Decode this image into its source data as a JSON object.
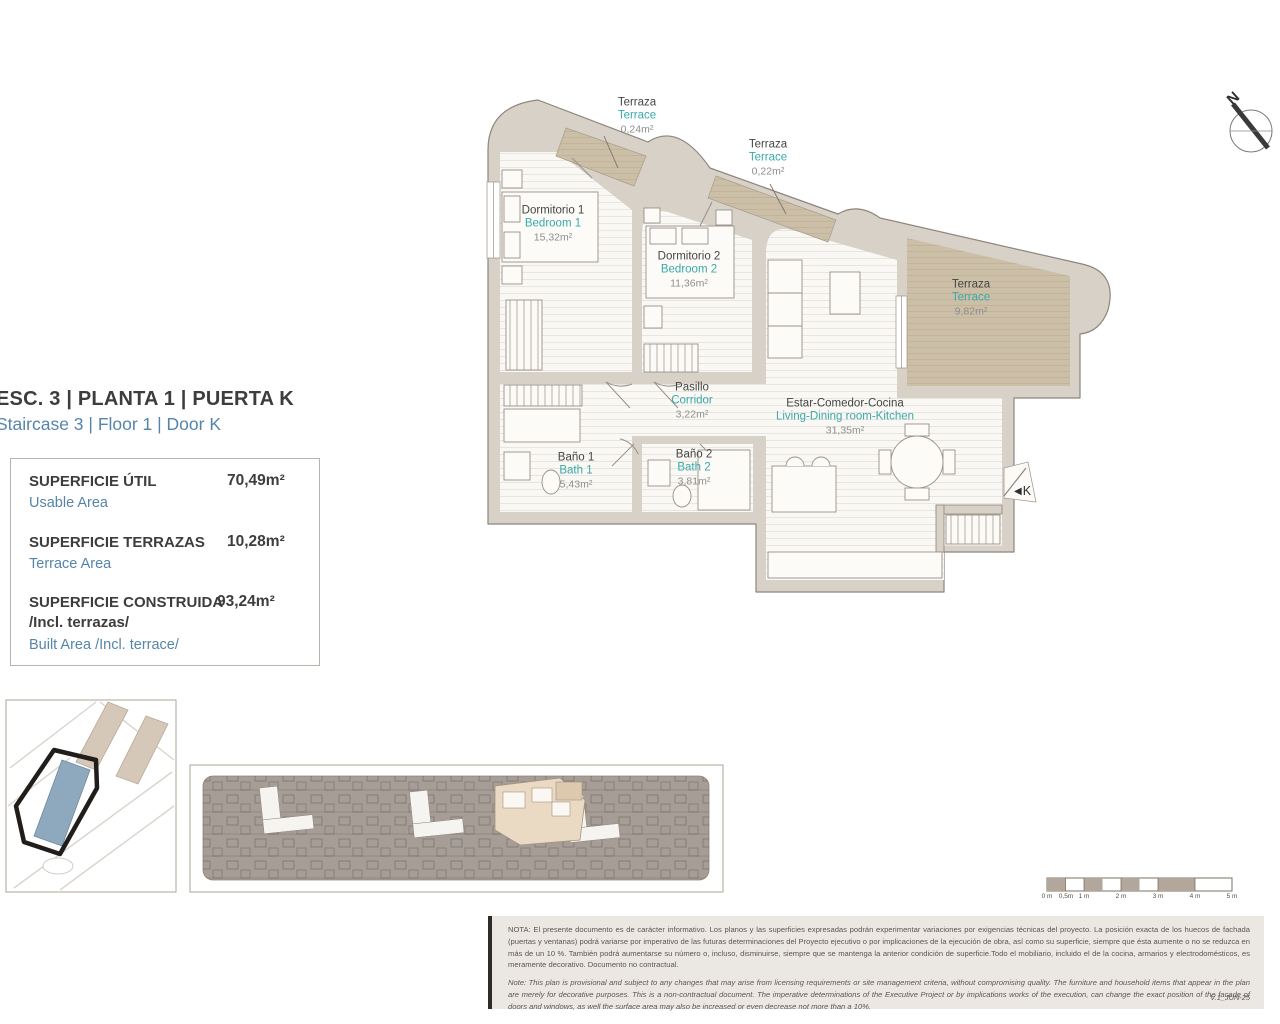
{
  "header": {
    "title_es": "ESC. 3 | PLANTA 1 | PUERTA K",
    "title_en": "Staircase 3 | Floor 1 | Door K"
  },
  "area_table": {
    "rows": [
      {
        "es": "SUPERFICIE ÚTIL",
        "en": "Usable Area",
        "value": "70,49m²"
      },
      {
        "es": "SUPERFICIE TERRAZAS",
        "en": "Terrace Area",
        "value": "10,28m²"
      },
      {
        "es": "SUPERFICIE CONSTRUIDA",
        "es_sub": "/Incl. terrazas/",
        "en": "Built Area /Incl. terrace/",
        "value": "93,24m²"
      }
    ]
  },
  "rooms": [
    {
      "es": "Terraza",
      "en": "Terrace",
      "area": "0,24m²"
    },
    {
      "es": "Terraza",
      "en": "Terrace",
      "area": "0,22m²"
    },
    {
      "es": "Dormitorio 1",
      "en": "Bedroom 1",
      "area": "15,32m²"
    },
    {
      "es": "Dormitorio 2",
      "en": "Bedroom 2",
      "area": "11,36m²"
    },
    {
      "es": "Terraza",
      "en": "Terrace",
      "area": "9,82m²"
    },
    {
      "es": "Pasillo",
      "en": "Corridor",
      "area": "3,22m²"
    },
    {
      "es": "Estar-Comedor-Cocina",
      "en": "Living-Dining room-Kitchen",
      "area": "31,35m²"
    },
    {
      "es": "Baño 1",
      "en": "Bath 1",
      "area": "5,43m²"
    },
    {
      "es": "Baño 2",
      "en": "Bath 2",
      "area": "3,81m²"
    }
  ],
  "entrance": {
    "icon": "◀",
    "label": "K"
  },
  "north": {
    "label": "N"
  },
  "scale_bar": {
    "labels": [
      "0 m",
      "0,5m",
      "1 m",
      "2 m",
      "3 m",
      "4 m",
      "5 m"
    ]
  },
  "note": {
    "es": "NOTA:  El presente documento es de carácter informativo. Los planos y las superficies expresadas podrán experimentar variaciones por exigencias técnicas del proyecto. La posición exacta de los huecos de fachada (puertas y ventanas) podrá variarse por imperativo de las futuras determinaciones del Proyecto ejecutivo o por implicaciones de la ejecución de obra, así como su superficie, siempre que ésta aumente o no se reduzca en más de un 10 %. También podrá aumentarse su número o, incluso, disminuirse, siempre que se mantenga la anterior condición de superficie.Todo el mobiliario, incluido el de la cocina, armarios y electrodomésticos, es meramente decorativo. Documento no contractual.",
    "en": "Note: This plan is provisional and subject to any changes that may arise from licensing requirements or site management criteria, without compromising quality. The furniture and household items that appear in the plan are merely for decorative purposes. This is a non-contractual document. The imperative determinations of the Executive Project or by implications works of the execution, can change the exact position of the facade of doors and windows, as well the surface area may also be increased or even decrease not more than a 10%.",
    "version": "V.1_JUN-25"
  },
  "colors": {
    "wall": "#d7d1c8",
    "terrace": "#ccbfa7",
    "teal": "#3aa9a9",
    "blue": "#5585aa",
    "dark": "#3d3d3d",
    "highlight_unit": "#ead9c3",
    "site_unit_blue": "#8ea9bd",
    "strip_gray": "#a69d96"
  }
}
